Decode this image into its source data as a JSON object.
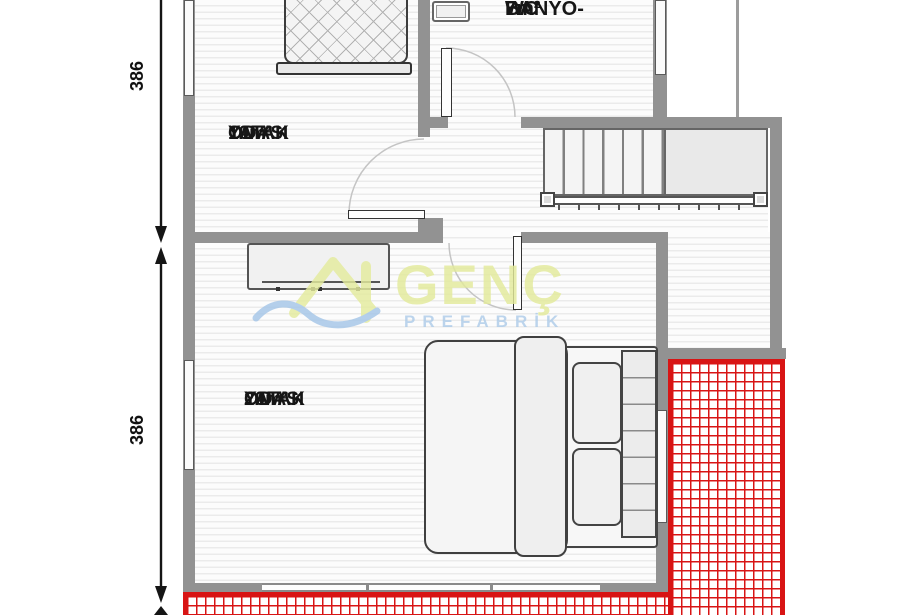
{
  "plan": {
    "type": "architectural-floor-plan",
    "rooms": [
      {
        "name": "banyo-wc",
        "line1": "BANYO-",
        "line2": "WC",
        "area": "7m²"
      },
      {
        "name": "yatak-odasi-10",
        "line1": "YATAK",
        "line2": "ODASI",
        "area": "10m²"
      },
      {
        "name": "yatak-odasi-20",
        "line1": "YATAK",
        "line2": "ODASI",
        "area": "20m²"
      }
    ],
    "dimensions": {
      "left_top": "386",
      "left_bottom": "386"
    },
    "watermark": {
      "brand": "GENÇ",
      "brand_sub": "PREFABRİK",
      "brand_color": "#e3ea9b",
      "sub_color": "#aecce9"
    },
    "colors": {
      "wall": "#929292",
      "balcony_hatch": "#d81414",
      "stair_fill": "#e9e9e9"
    }
  }
}
